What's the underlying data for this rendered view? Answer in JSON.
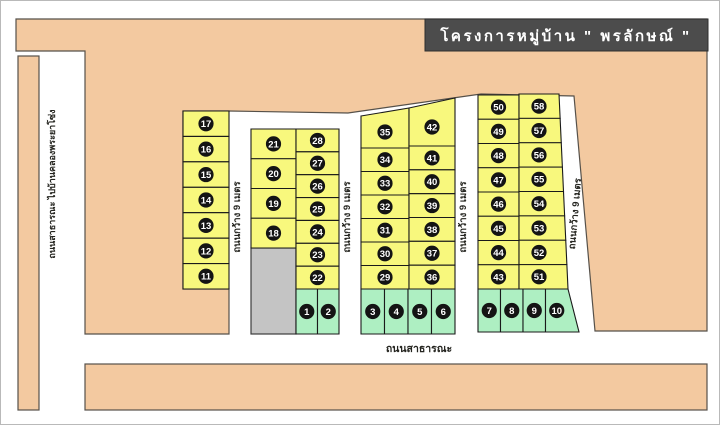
{
  "title": "โครงการหมู่บ้าน \" พรลักษณ์ \"",
  "road_labels": {
    "left_vertical": "ถนนสาธารณะ ไปบ้านคลองพระยาโซ่ง",
    "bottom": "ถนนสาธารณะ",
    "inner_width": "ถนนกว้าง 9 เมตร"
  },
  "lot_groups": {
    "left_column": [
      17,
      16,
      15,
      14,
      13,
      12,
      11
    ],
    "block2_left": [
      21,
      20,
      19,
      18
    ],
    "block2_right": [
      28,
      27,
      26,
      25,
      24,
      23,
      22
    ],
    "block2_green": [
      1,
      2
    ],
    "block3_left": [
      35,
      34,
      33,
      32,
      31,
      30,
      29
    ],
    "block3_right": [
      42,
      41,
      40,
      39,
      38,
      37,
      36
    ],
    "block3_green": [
      3,
      4,
      5,
      6
    ],
    "block4_left": [
      50,
      49,
      48,
      47,
      46,
      45,
      44,
      43
    ],
    "block4_right": [
      58,
      57,
      56,
      55,
      54,
      53,
      52,
      51
    ],
    "block4_green": [
      7,
      8,
      9,
      10
    ]
  },
  "colors": {
    "land": "#F3C9A0",
    "lot_yellow": "#F8F87D",
    "lot_green": "#AEEFC2",
    "reserved_gray": "#C4C4C4",
    "title_bg": "#4C4C4C",
    "title_text": "#FFFFFF",
    "number_circle": "#141414"
  }
}
